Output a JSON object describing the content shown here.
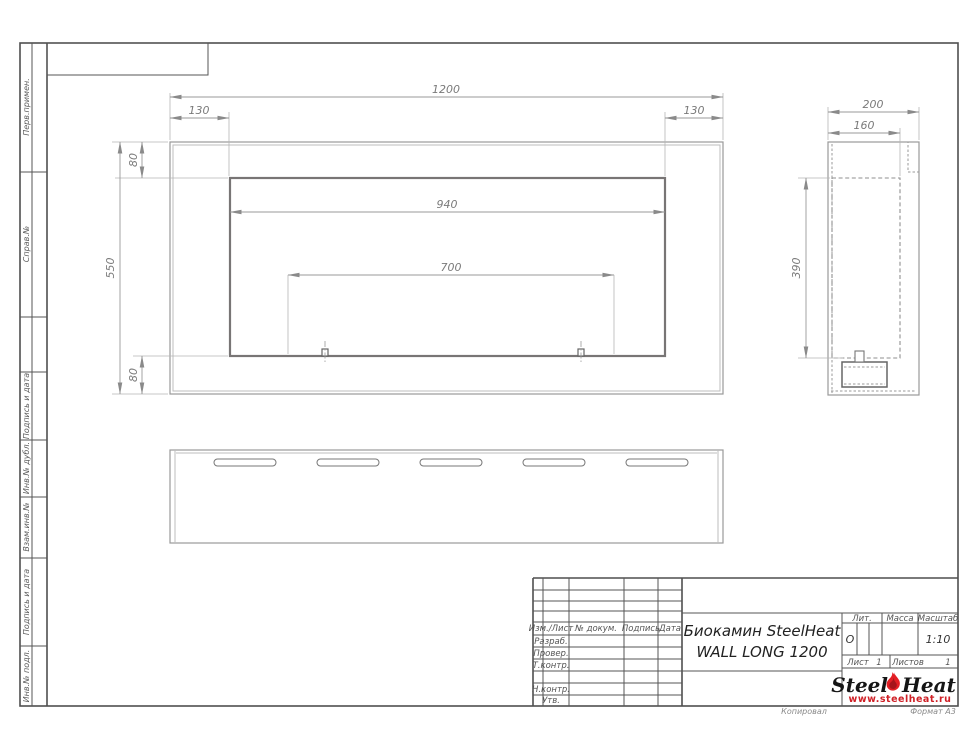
{
  "document": {
    "type_note": "GOST engineering drawing sheet",
    "colors": {
      "brand_red": "#e31e24",
      "line_gray": "#8f8f8f"
    }
  },
  "front_view": {
    "width": "1200",
    "inset_left": "130",
    "inset_right": "130",
    "top_flange": "80",
    "height": "550",
    "bottom_flange": "80",
    "opening_width": "940",
    "burner_span": "700"
  },
  "side_view": {
    "depth": "200",
    "inner_depth": "160",
    "inner_height": "390"
  },
  "sidebar": {
    "items": [
      {
        "label": "Перв.примен."
      },
      {
        "label": "Справ.№"
      },
      {
        "label": "Подпись и дата"
      },
      {
        "label": "Инв.№ дубл."
      },
      {
        "label": "Взам.инв.№"
      },
      {
        "label": "Подпись и дата"
      },
      {
        "label": "Инв.№ подл."
      }
    ]
  },
  "title_block": {
    "header": {
      "izm": "Изм./Лист",
      "doc": "№ докум.",
      "sign": "Подпись",
      "date": "Дата"
    },
    "rows": [
      {
        "label": "Разраб."
      },
      {
        "label": "Провер."
      },
      {
        "label": "Т.контр."
      },
      {
        "label": "Н.контр."
      },
      {
        "label": "Утв."
      }
    ],
    "title_line1": "Биокамин SteelHeat",
    "title_line2": "WALL LONG 1200",
    "lit_label": "Лит.",
    "lit_value": "О",
    "mass_label": "Масса",
    "scale_label": "Масштаб",
    "scale_value": "1:10",
    "sheet_label": "Лист",
    "sheet_value": "1",
    "sheets_label": "Листов",
    "sheets_value": "1"
  },
  "logo": {
    "part1": "Steel",
    "part2": "Heat",
    "url": "www.steelheat.ru"
  },
  "footer": {
    "copied": "Копировал",
    "format": "Формат А3"
  }
}
